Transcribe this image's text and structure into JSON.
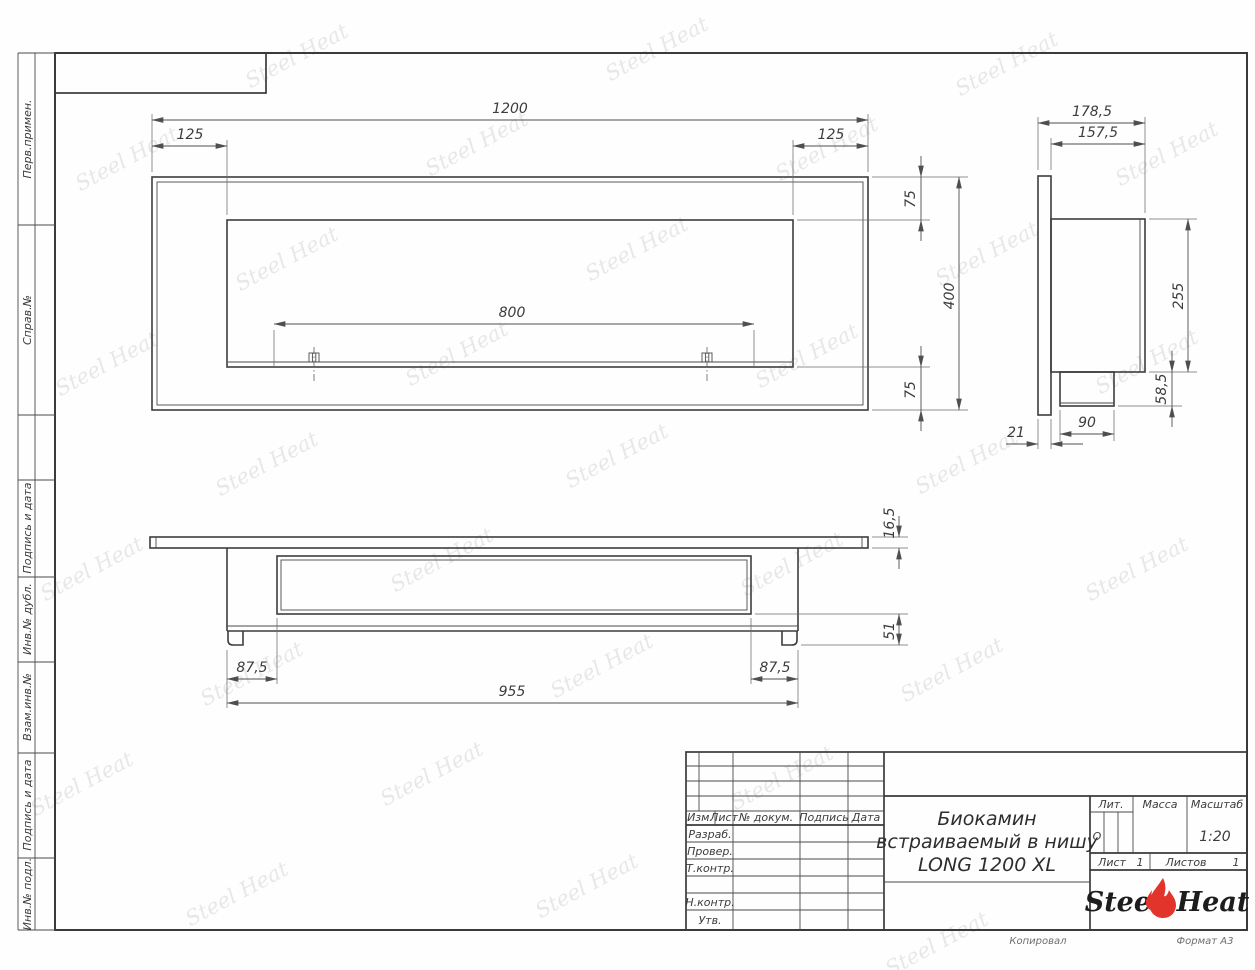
{
  "drawing": {
    "watermark_text": "Steel Heat",
    "accent_red": "#e2342b",
    "line_color": "#3d3d3d"
  },
  "margin_labels": {
    "items": [
      {
        "label": "Перв.примен."
      },
      {
        "label": "Справ.№"
      },
      {
        "label": "Подпись и дата"
      },
      {
        "label": "Инв.№ дубл."
      },
      {
        "label": "Взам.инв.№"
      },
      {
        "label": "Подпись и дата"
      },
      {
        "label": "Инв.№ подл."
      }
    ]
  },
  "front_view": {
    "dim_total_width": "1200",
    "dim_left_offset": "125",
    "dim_right_offset": "125",
    "dim_burner": "800",
    "dim_top_offset": "75",
    "dim_height": "400",
    "dim_bottom_offset": "75"
  },
  "side_view": {
    "dim_depth_total": "178,5",
    "dim_depth_body": "157,5",
    "dim_body_height": "255",
    "dim_box_height": "58,5",
    "dim_box_width": "90",
    "dim_flange_thickness": "21"
  },
  "plan_view": {
    "dim_bar_thickness": "16,5",
    "dim_rail_height": "51",
    "dim_left_offset": "87,5",
    "dim_right_offset": "87,5",
    "dim_body_width": "955"
  },
  "title_block": {
    "rev_headers": {
      "izm": "Изм.",
      "list": "Лист",
      "doc": "№ докум.",
      "sign": "Подпись",
      "date": "Дата"
    },
    "rows": [
      "Разраб.",
      "Провер.",
      "Т.контр.",
      "Н.контр.",
      "Утв."
    ],
    "title_line1": "Биокамин",
    "title_line2": "встраиваемый в нишу",
    "title_line3": "LONG 1200 XL",
    "lit_label": "Лит.",
    "lit_value": "О",
    "mass_label": "Масса",
    "scale_label": "Масштаб",
    "scale_value": "1:20",
    "sheet_label": "Лист",
    "sheet_value": "1",
    "sheets_label": "Листов",
    "sheets_value": "1",
    "logo_steel": "Steel",
    "logo_heat": "Heat",
    "copied": "Копировал",
    "format": "Формат А3"
  }
}
